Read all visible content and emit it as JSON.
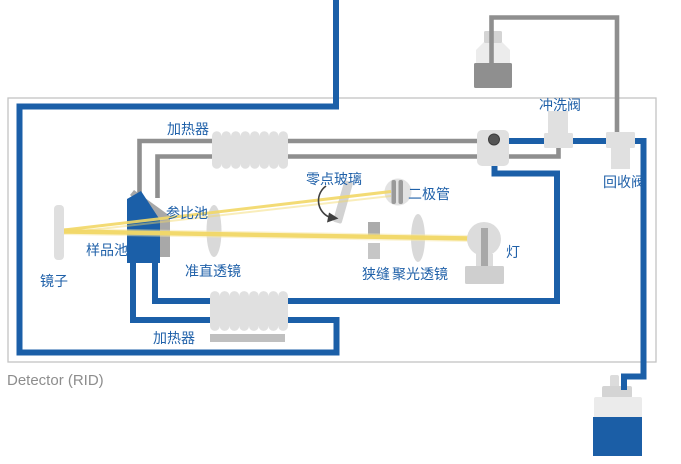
{
  "title": "Detector (RID)",
  "labels": {
    "heater_top": "加热器",
    "reference_cell": "参比池",
    "sample_cell": "样品池",
    "mirror": "镜子",
    "collimating_lens": "准直透镜",
    "zero_glass": "零点玻璃",
    "diode": "二极管",
    "slit": "狭缝",
    "condensing_lens": "聚光透镜",
    "lamp": "灯",
    "flush_valve": "冲洗阀",
    "recycle_valve": "回收阀",
    "heater_bottom": "加热器"
  },
  "colors": {
    "tube_blue": "#1B5FA8",
    "tube_gray": "#8F8F8F",
    "component_light_gray": "#DEDEDE",
    "component_mid_gray": "#A8A8A8",
    "beam_yellow": "#F2D867",
    "beam_glow": "#F8E9A8",
    "label_blue": "#2061A9",
    "title_gray": "#8D8D8D",
    "waste_liquid_blue": "#1B5EA6",
    "recycle_liquid_gray": "#8F8F8F",
    "enclosure_border_gray": "#C4C4C4"
  }
}
